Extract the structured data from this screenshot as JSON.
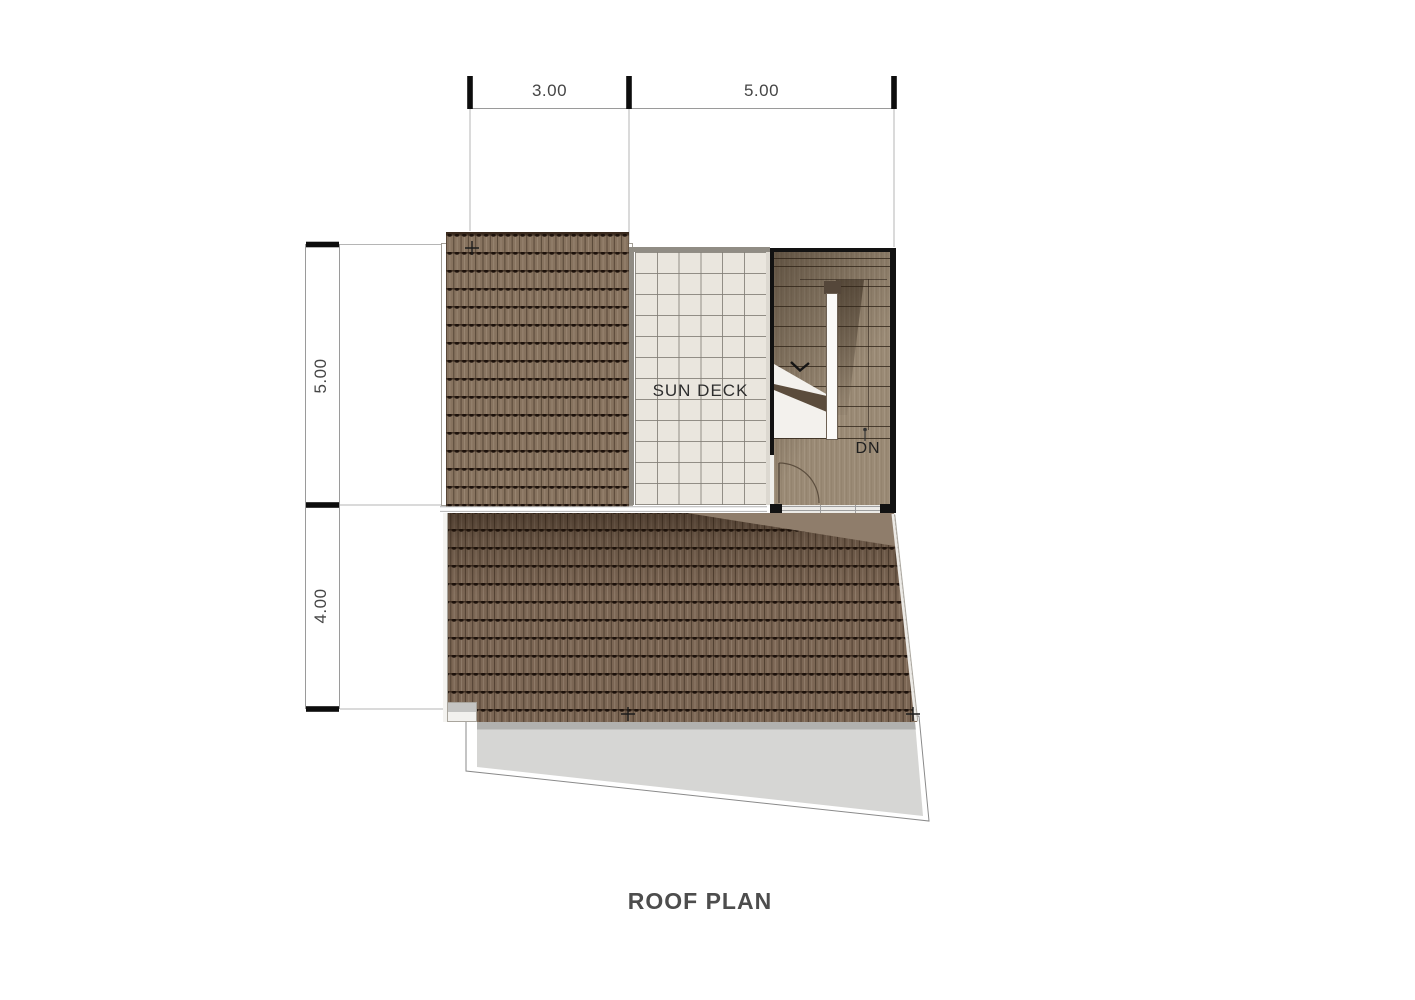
{
  "page": {
    "title": "ROOF PLAN"
  },
  "plan": {
    "deck_label": "SUN DECK",
    "stair": {
      "down_label": "DN"
    }
  },
  "dimensions": {
    "top": {
      "segments": [
        {
          "label": "3.00"
        },
        {
          "label": "5.00"
        }
      ]
    },
    "left": {
      "segments": [
        {
          "label": "5.00"
        },
        {
          "label": "4.00"
        }
      ]
    }
  },
  "colors": {
    "roof_tile_upper": "#87735f",
    "roof_tile_lower": "#7b6654",
    "wood_floor": "#9a8a75",
    "deck_tile": "#eae6de",
    "canopy_gray": "#d6d6d4",
    "border_ink": "#141414",
    "dim_text": "#454545",
    "title_text": "#4d4d4d"
  }
}
